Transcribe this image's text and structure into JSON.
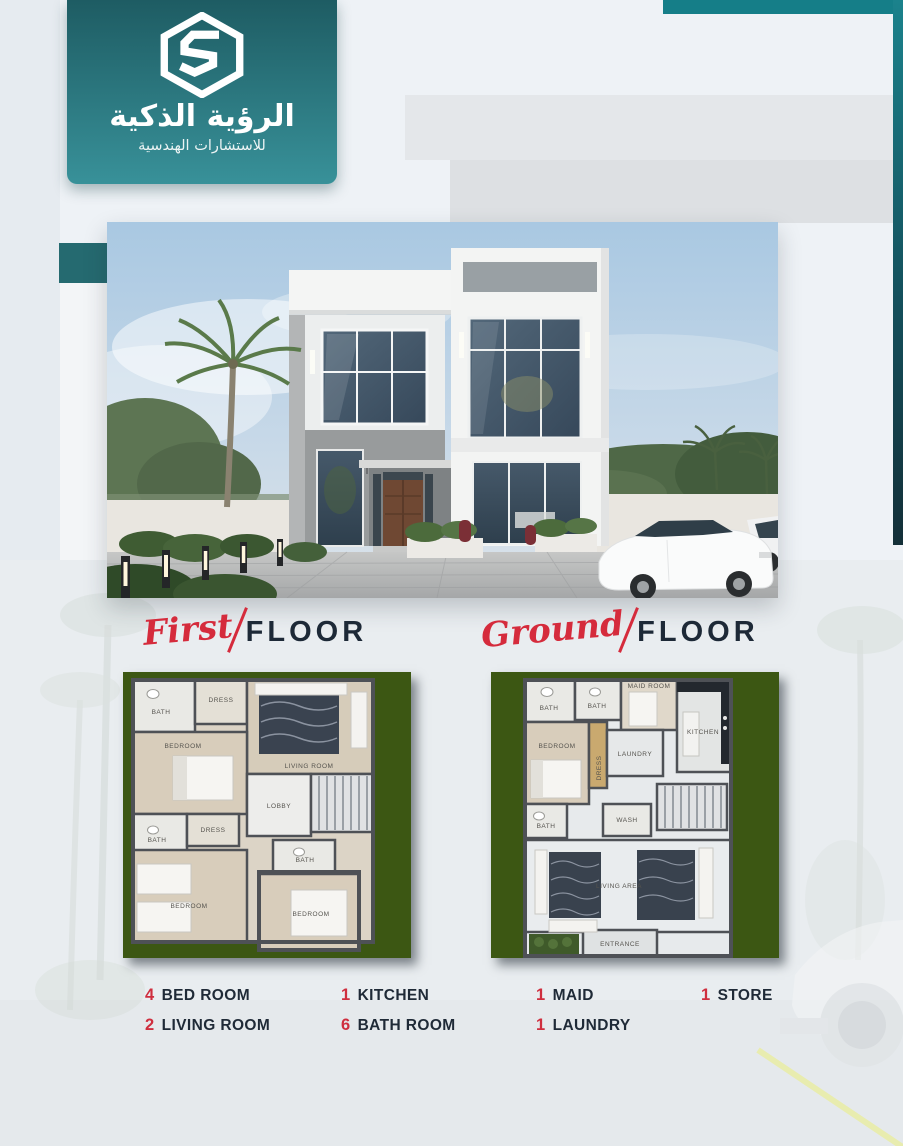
{
  "brand": {
    "title_ar": "الرؤية الذكية",
    "subtitle_ar": "للاستشارات الهندسية",
    "logo_icon": "hexagon-s-monogram"
  },
  "colors": {
    "badge_gradient_top": "#1e5c63",
    "badge_gradient_bottom": "#389199",
    "top_bar_teal": "#157e88",
    "accent_square_teal": "#256a70",
    "plan_panel_green": "#3c5713",
    "script_red": "#d52b3c",
    "heading_navy": "#1d2937",
    "legend_number_red": "#cf2e3e"
  },
  "hero": {
    "alt": "modern two-storey white villa exterior render with palm trees and cars"
  },
  "sections": {
    "first_floor": {
      "script_word": "First",
      "title_word": "FLOOR"
    },
    "ground_floor": {
      "script_word": "Ground",
      "title_word": "FLOOR"
    }
  },
  "plans": {
    "first_floor": {
      "rooms": [
        "BATH",
        "DRESS",
        "LIVING ROOM",
        "BEDROOM",
        "LOBBY",
        "BATH",
        "DRESS",
        "BEDROOM",
        "BATH",
        "BEDROOM"
      ]
    },
    "ground_floor": {
      "rooms": [
        "BATH",
        "BATH",
        "MAID ROOM",
        "KITCHEN",
        "BEDROOM",
        "DRESS",
        "LAUNDRY",
        "BATH",
        "WASH",
        "LIVING AREA",
        "ENTRANCE"
      ]
    }
  },
  "legend": {
    "items": [
      {
        "count": "4",
        "label": "BED ROOM"
      },
      {
        "count": "1",
        "label": "KITCHEN"
      },
      {
        "count": "1",
        "label": "MAID"
      },
      {
        "count": "1",
        "label": "STORE"
      },
      {
        "count": "2",
        "label": "LIVING ROOM"
      },
      {
        "count": "6",
        "label": "BATH ROOM"
      },
      {
        "count": "1",
        "label": "LAUNDRY"
      }
    ]
  }
}
